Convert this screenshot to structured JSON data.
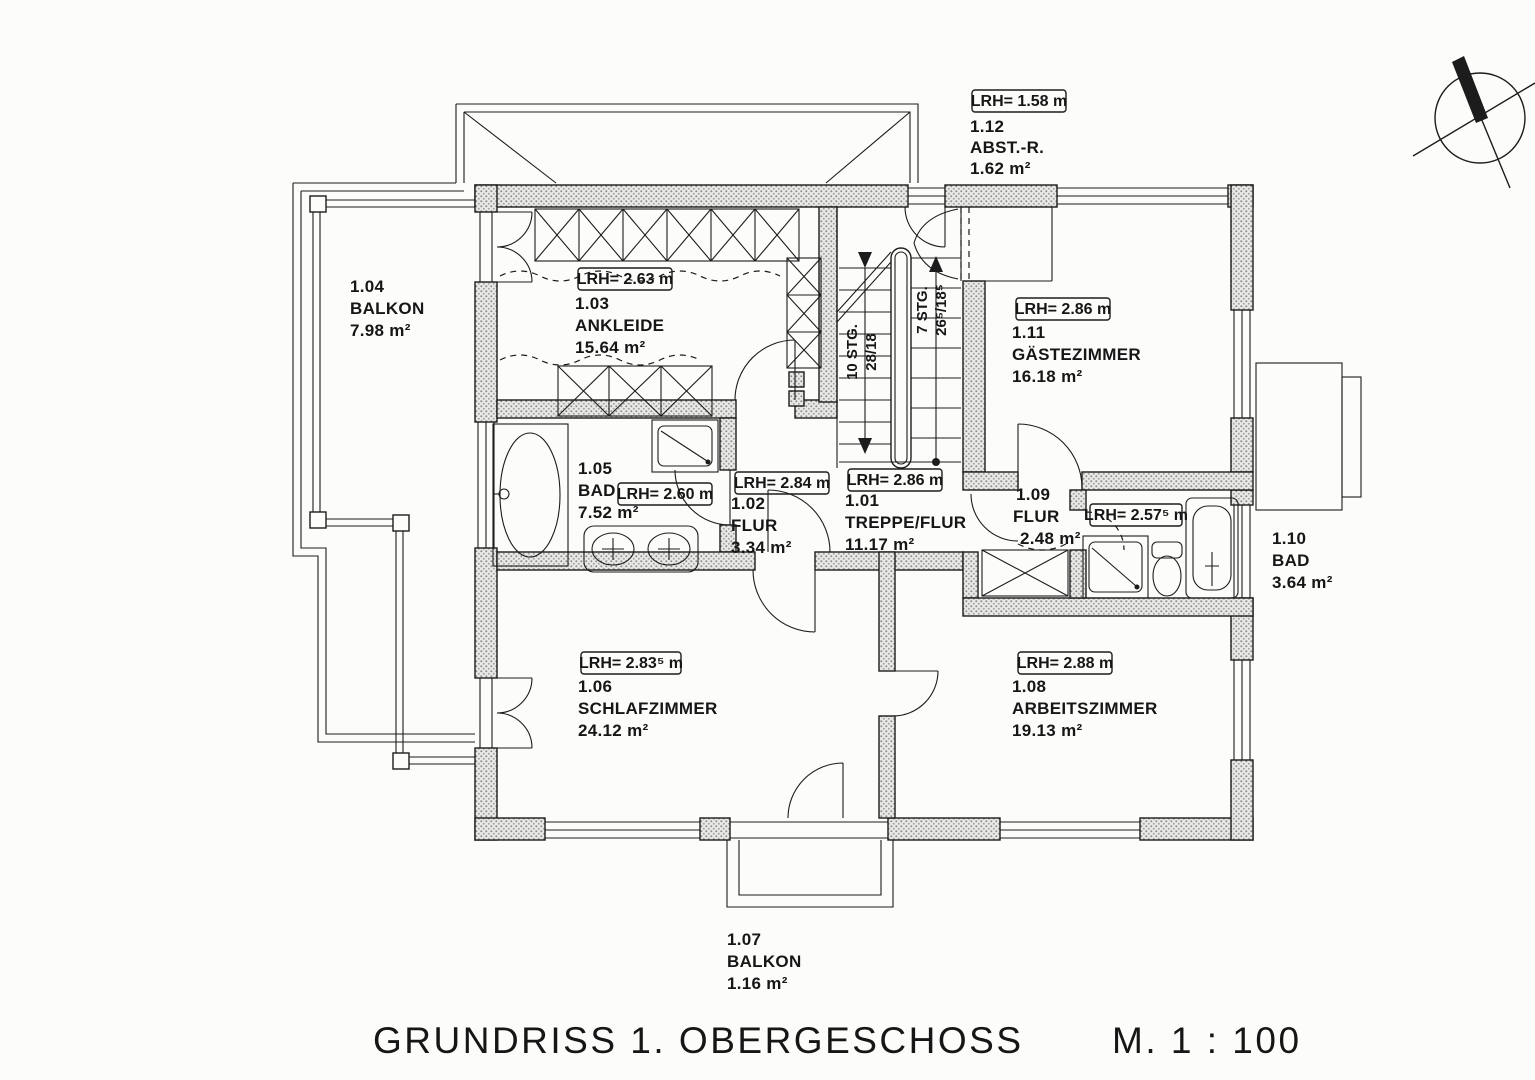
{
  "meta": {
    "title": "GRUNDRISS 1. OBERGESCHOSS",
    "scale": "M. 1 : 100"
  },
  "rooms": {
    "r101": {
      "id": "1.01",
      "name": "TREPPE/FLUR",
      "area": "11.17 m²",
      "lrh": "LRH= 2.86 m"
    },
    "r102": {
      "id": "1.02",
      "name": "FLUR",
      "area": "3.34 m²",
      "lrh": "LRH= 2.84 m"
    },
    "r103": {
      "id": "1.03",
      "name": "ANKLEIDE",
      "area": "15.64 m²",
      "lrh": "LRH= 2.63 m"
    },
    "r104": {
      "id": "1.04",
      "name": "BALKON",
      "area": "7.98 m²"
    },
    "r105": {
      "id": "1.05",
      "name": "BAD",
      "area": "7.52 m²",
      "lrh": "LRH= 2.60 m"
    },
    "r106": {
      "id": "1.06",
      "name": "SCHLAFZIMMER",
      "area": "24.12 m²",
      "lrh": "LRH= 2.83⁵ m"
    },
    "r107": {
      "id": "1.07",
      "name": "BALKON",
      "area": "1.16 m²"
    },
    "r108": {
      "id": "1.08",
      "name": "ARBEITSZIMMER",
      "area": "19.13 m²",
      "lrh": "LRH= 2.88 m"
    },
    "r109": {
      "id": "1.09",
      "name": "FLUR",
      "area": "2.48 m²"
    },
    "r110": {
      "id": "1.10",
      "name": "BAD",
      "area": "3.64 m²",
      "lrh": "LRH= 2.57⁵ m"
    },
    "r111": {
      "id": "1.11",
      "name": "GÄSTEZIMMER",
      "area": "16.18 m²",
      "lrh": "LRH= 2.86 m"
    },
    "r112": {
      "id": "1.12",
      "name": "ABST.-R.",
      "area": "1.62 m²",
      "lrh": "LRH= 1.58 m"
    }
  },
  "stairs": {
    "flight_left": {
      "steps": "10 STG.",
      "ratio": "28/18"
    },
    "flight_right": {
      "steps": "7 STG.",
      "ratio": "26⁵/18⁵"
    }
  },
  "colors": {
    "ink": "#1c1c1c",
    "wall_fill": "#9a9a9a",
    "paper": "#fcfcfa"
  }
}
